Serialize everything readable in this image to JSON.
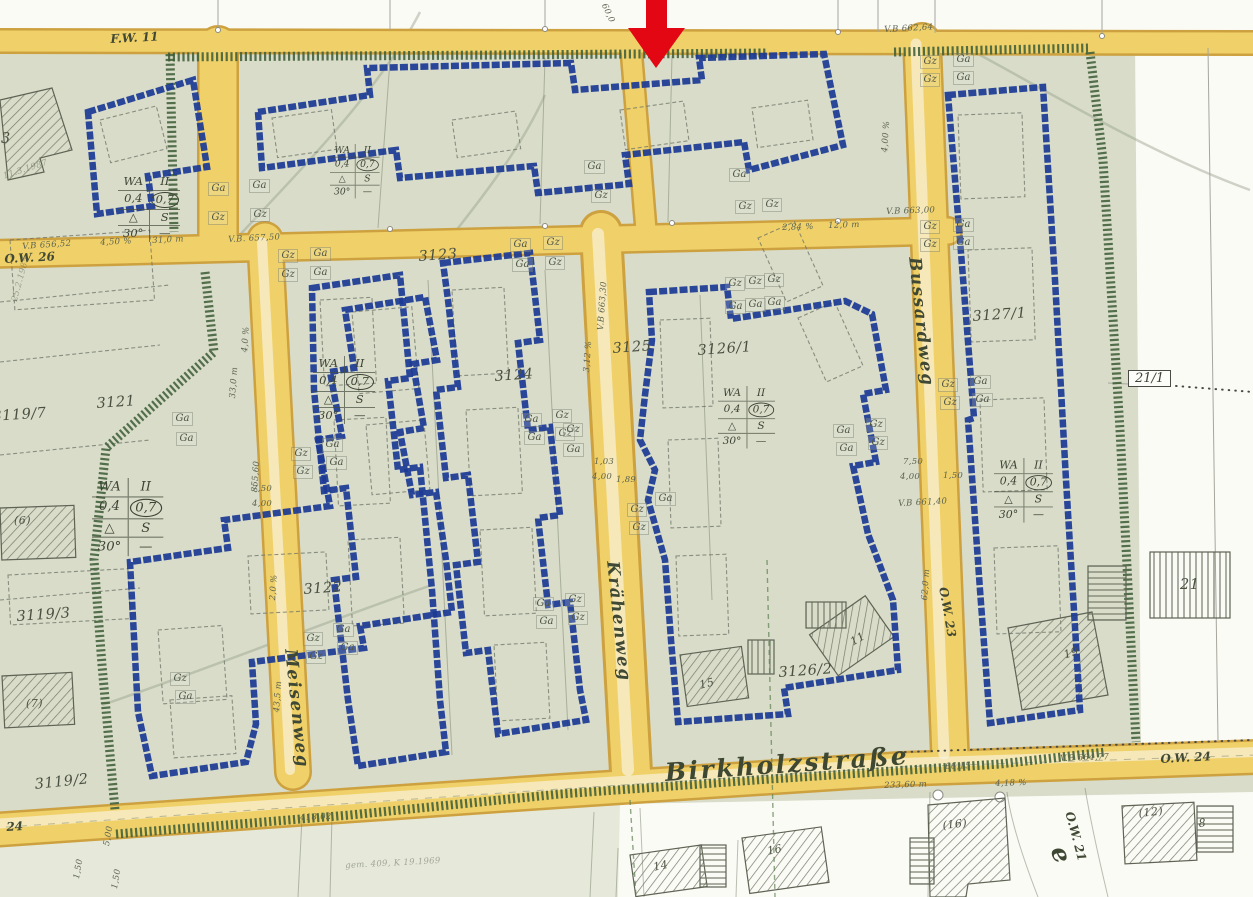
{
  "map": {
    "title": "Bebauungsplan Ausschnitt Birkholzstraße",
    "colors": {
      "envelope_blue": "#1c3a94",
      "road_fill": "#f0d169",
      "road_edge": "#cda13f",
      "boundary_green": "#3f5e38",
      "arrow_red": "#e30613",
      "plan_wash": "#d8dcc9"
    },
    "marker": {
      "name": "red-arrow",
      "color": "#e30613"
    },
    "street_labels": [
      {
        "t": "F.W. 11",
        "x": 110,
        "y": 32,
        "r": -3,
        "s": "sm"
      },
      {
        "t": "O.W. 26",
        "x": 4,
        "y": 252,
        "r": -3,
        "s": "sm"
      },
      {
        "t": "Meisenweg",
        "x": 300,
        "y": 648,
        "r": 84,
        "s": "lg"
      },
      {
        "t": "Krähenweg",
        "x": 622,
        "y": 560,
        "r": 84,
        "s": "lg"
      },
      {
        "t": "Bussardweg",
        "x": 924,
        "y": 256,
        "r": 84,
        "s": "lg"
      },
      {
        "t": "Birkholzstraße",
        "x": 664,
        "y": 758,
        "r": -4,
        "s": "xl"
      },
      {
        "t": "O.W. 23",
        "x": 950,
        "y": 586,
        "r": 80,
        "s": "sm"
      },
      {
        "t": "O.W. 24",
        "x": 1160,
        "y": 752,
        "r": -3,
        "s": "sm"
      },
      {
        "t": "O.W. 21",
        "x": 1076,
        "y": 810,
        "r": 75,
        "s": "sm"
      },
      {
        "t": "24",
        "x": 6,
        "y": 820,
        "r": -3,
        "s": "sm"
      },
      {
        "t": "e",
        "x": 1072,
        "y": 842,
        "r": 70,
        "s": "xl"
      }
    ],
    "parcel_labels": [
      {
        "t": "3121",
        "x": 96,
        "y": 396,
        "r": -4
      },
      {
        "t": "3122",
        "x": 303,
        "y": 582,
        "r": -4
      },
      {
        "t": "3123",
        "x": 418,
        "y": 249,
        "r": -4
      },
      {
        "t": "3124",
        "x": 494,
        "y": 369,
        "r": -4
      },
      {
        "t": "3125",
        "x": 612,
        "y": 341,
        "r": -4
      },
      {
        "t": "3126/1",
        "x": 697,
        "y": 343,
        "r": -4
      },
      {
        "t": "3126/2",
        "x": 778,
        "y": 665,
        "r": -4
      },
      {
        "t": "3127/1",
        "x": 972,
        "y": 309,
        "r": -4
      },
      {
        "t": "3119/7",
        "x": -8,
        "y": 409,
        "r": -4
      },
      {
        "t": "3119/3",
        "x": 16,
        "y": 609,
        "r": -4
      },
      {
        "t": "3119/2",
        "x": 34,
        "y": 777,
        "r": -6
      },
      {
        "t": "21",
        "x": 1180,
        "y": 577,
        "r": 0
      },
      {
        "t": "19",
        "x": 1062,
        "y": 649,
        "r": -18,
        "sm": true
      },
      {
        "t": "3",
        "x": 1,
        "y": 131,
        "r": 0
      },
      {
        "t": "(6)",
        "x": 14,
        "y": 514,
        "r": 0,
        "sm": true
      },
      {
        "t": "(7)",
        "x": 26,
        "y": 697,
        "r": 0,
        "sm": true
      },
      {
        "t": "(16)",
        "x": 942,
        "y": 819,
        "r": -6,
        "sm": true
      },
      {
        "t": "(12)",
        "x": 1138,
        "y": 807,
        "r": -6,
        "sm": true
      },
      {
        "t": "14",
        "x": 652,
        "y": 861,
        "r": -12,
        "sm": true
      },
      {
        "t": "16",
        "x": 766,
        "y": 845,
        "r": -12,
        "sm": true
      },
      {
        "t": "15",
        "x": 698,
        "y": 679,
        "r": -14,
        "sm": true
      },
      {
        "t": "11",
        "x": 848,
        "y": 637,
        "r": -30,
        "sm": true
      },
      {
        "t": "8",
        "x": 1198,
        "y": 817,
        "r": -6,
        "sm": true
      }
    ],
    "parcel_box": {
      "t": "21/1",
      "x": 1128,
      "y": 370
    },
    "garage_labels": [
      {
        "t": "Ga",
        "x": 208,
        "y": 182
      },
      {
        "t": "Gz",
        "x": 208,
        "y": 211
      },
      {
        "t": "Ga",
        "x": 249,
        "y": 179
      },
      {
        "t": "Gz",
        "x": 250,
        "y": 208
      },
      {
        "t": "Ga",
        "x": 584,
        "y": 160
      },
      {
        "t": "Gz",
        "x": 591,
        "y": 189
      },
      {
        "t": "Ga",
        "x": 729,
        "y": 168
      },
      {
        "t": "Gz",
        "x": 735,
        "y": 200
      },
      {
        "t": "Gz",
        "x": 762,
        "y": 198
      },
      {
        "t": "Gz",
        "x": 920,
        "y": 55
      },
      {
        "t": "Ga",
        "x": 953,
        "y": 53
      },
      {
        "t": "Gz",
        "x": 920,
        "y": 73
      },
      {
        "t": "Ga",
        "x": 953,
        "y": 71
      },
      {
        "t": "Gz",
        "x": 920,
        "y": 220
      },
      {
        "t": "Ga",
        "x": 953,
        "y": 218
      },
      {
        "t": "Gz",
        "x": 920,
        "y": 238
      },
      {
        "t": "Ga",
        "x": 953,
        "y": 236
      },
      {
        "t": "Gz",
        "x": 278,
        "y": 249
      },
      {
        "t": "Ga",
        "x": 310,
        "y": 247
      },
      {
        "t": "Gz",
        "x": 278,
        "y": 268
      },
      {
        "t": "Ga",
        "x": 310,
        "y": 266
      },
      {
        "t": "Ga",
        "x": 510,
        "y": 238
      },
      {
        "t": "Gz",
        "x": 543,
        "y": 236
      },
      {
        "t": "Ga",
        "x": 512,
        "y": 258
      },
      {
        "t": "Gz",
        "x": 545,
        "y": 256
      },
      {
        "t": "Ga",
        "x": 172,
        "y": 412
      },
      {
        "t": "Ga",
        "x": 176,
        "y": 432
      },
      {
        "t": "Ga",
        "x": 322,
        "y": 438
      },
      {
        "t": "Gz",
        "x": 291,
        "y": 447
      },
      {
        "t": "Ga",
        "x": 326,
        "y": 456
      },
      {
        "t": "Gz",
        "x": 293,
        "y": 465
      },
      {
        "t": "Ga",
        "x": 521,
        "y": 413
      },
      {
        "t": "Gz",
        "x": 552,
        "y": 409
      },
      {
        "t": "Ga",
        "x": 524,
        "y": 431
      },
      {
        "t": "Gz",
        "x": 555,
        "y": 427
      },
      {
        "t": "Gz",
        "x": 725,
        "y": 277
      },
      {
        "t": "Gz",
        "x": 745,
        "y": 275
      },
      {
        "t": "Gz",
        "x": 764,
        "y": 273
      },
      {
        "t": "Ga",
        "x": 725,
        "y": 300
      },
      {
        "t": "Ga",
        "x": 745,
        "y": 298
      },
      {
        "t": "Ga",
        "x": 764,
        "y": 296
      },
      {
        "t": "Ga",
        "x": 833,
        "y": 424
      },
      {
        "t": "Gz",
        "x": 866,
        "y": 418
      },
      {
        "t": "Ga",
        "x": 836,
        "y": 442
      },
      {
        "t": "Gz",
        "x": 868,
        "y": 436
      },
      {
        "t": "Gz",
        "x": 938,
        "y": 378
      },
      {
        "t": "Ga",
        "x": 970,
        "y": 375
      },
      {
        "t": "Gz",
        "x": 940,
        "y": 396
      },
      {
        "t": "Ga",
        "x": 972,
        "y": 393
      },
      {
        "t": "Gz",
        "x": 563,
        "y": 423
      },
      {
        "t": "Ga",
        "x": 563,
        "y": 443
      },
      {
        "t": "Ga",
        "x": 655,
        "y": 492
      },
      {
        "t": "Gz",
        "x": 627,
        "y": 503
      },
      {
        "t": "Gz",
        "x": 629,
        "y": 521
      },
      {
        "t": "Ga",
        "x": 333,
        "y": 623
      },
      {
        "t": "Gz",
        "x": 303,
        "y": 632
      },
      {
        "t": "Ga",
        "x": 337,
        "y": 641
      },
      {
        "t": "Gz",
        "x": 306,
        "y": 650
      },
      {
        "t": "Ga",
        "x": 533,
        "y": 597
      },
      {
        "t": "Gz",
        "x": 565,
        "y": 593
      },
      {
        "t": "Ga",
        "x": 536,
        "y": 615
      },
      {
        "t": "Gz",
        "x": 568,
        "y": 611
      },
      {
        "t": "Gz",
        "x": 170,
        "y": 672
      },
      {
        "t": "Ga",
        "x": 175,
        "y": 690
      }
    ],
    "dimension_labels": [
      {
        "t": "60,0",
        "x": 608,
        "y": 2,
        "r": 65
      },
      {
        "t": "V.B 662,64",
        "x": 884,
        "y": 25,
        "r": -3
      },
      {
        "t": "4,00 %",
        "x": 880,
        "y": 152,
        "r": -86
      },
      {
        "t": "V.B 656,52",
        "x": 22,
        "y": 242,
        "r": -4
      },
      {
        "t": "4,50 %",
        "x": 100,
        "y": 238,
        "r": -3
      },
      {
        "t": "31,0 m",
        "x": 152,
        "y": 236,
        "r": -3
      },
      {
        "t": "V.B. 657,50",
        "x": 228,
        "y": 235,
        "r": -3
      },
      {
        "t": "2,84 %",
        "x": 782,
        "y": 223,
        "r": -2
      },
      {
        "t": "12,0 m",
        "x": 828,
        "y": 221,
        "r": -2
      },
      {
        "t": "V.B 663,00",
        "x": 886,
        "y": 207,
        "r": -2
      },
      {
        "t": "4,0 %",
        "x": 240,
        "y": 352,
        "r": -86
      },
      {
        "t": "33,0 m",
        "x": 228,
        "y": 398,
        "r": -86
      },
      {
        "t": "855,60",
        "x": 250,
        "y": 492,
        "r": -86
      },
      {
        "t": "7,50",
        "x": 252,
        "y": 484,
        "r": 0
      },
      {
        "t": "4,00",
        "x": 252,
        "y": 499,
        "r": 0
      },
      {
        "t": "2,0 %",
        "x": 268,
        "y": 600,
        "r": -86
      },
      {
        "t": "43,5 m",
        "x": 272,
        "y": 712,
        "r": -86
      },
      {
        "t": "3,12 %",
        "x": 582,
        "y": 372,
        "r": -86
      },
      {
        "t": "V.B 663,30",
        "x": 596,
        "y": 330,
        "r": -86
      },
      {
        "t": "1,03",
        "x": 594,
        "y": 457,
        "r": 0
      },
      {
        "t": "4,00",
        "x": 592,
        "y": 472,
        "r": 0
      },
      {
        "t": "1,89",
        "x": 616,
        "y": 475,
        "r": 0
      },
      {
        "t": "7,50",
        "x": 903,
        "y": 457,
        "r": 0
      },
      {
        "t": "4,00",
        "x": 900,
        "y": 472,
        "r": 0
      },
      {
        "t": "1,50",
        "x": 943,
        "y": 471,
        "r": 0
      },
      {
        "t": "V.B 661,40",
        "x": 898,
        "y": 499,
        "r": -3
      },
      {
        "t": "62,0 m",
        "x": 920,
        "y": 600,
        "r": -86
      },
      {
        "t": "4,18 %",
        "x": 995,
        "y": 779,
        "r": -2
      },
      {
        "t": "66,15",
        "x": 945,
        "y": 762,
        "r": -2
      },
      {
        "t": "V.B 664,77",
        "x": 1060,
        "y": 754,
        "r": -2
      },
      {
        "t": "233,60 m",
        "x": 884,
        "y": 781,
        "r": -2
      },
      {
        "t": "418,02",
        "x": 300,
        "y": 813,
        "r": -2
      },
      {
        "t": "5,00",
        "x": 102,
        "y": 845,
        "r": -80
      },
      {
        "t": "1,50",
        "x": 72,
        "y": 878,
        "r": -80
      },
      {
        "t": "1,50",
        "x": 110,
        "y": 888,
        "r": -80
      },
      {
        "t": "gem. 409, K 19.1969",
        "x": 345,
        "y": 861,
        "r": -3,
        "f": true
      },
      {
        "t": "25.2.1985",
        "x": 10,
        "y": 300,
        "r": -75,
        "f": true
      },
      {
        "t": "11.3.1987",
        "x": 2,
        "y": 172,
        "r": -18,
        "f": true
      }
    ],
    "zoning": {
      "rows": [
        {
          "l": "WA",
          "r": "II"
        },
        {
          "l": "0,4",
          "r": "0,7",
          "oval": true
        },
        {
          "l": "△",
          "r": "S",
          "tri": true
        },
        {
          "l": "30°",
          "r": "—"
        }
      ],
      "boxes": [
        {
          "x": 118,
          "y": 174,
          "s": 1
        },
        {
          "x": 330,
          "y": 144,
          "s": 0.8
        },
        {
          "x": 313,
          "y": 356,
          "s": 1
        },
        {
          "x": 92,
          "y": 478,
          "s": 1.15
        },
        {
          "x": 718,
          "y": 386,
          "s": 0.92
        },
        {
          "x": 994,
          "y": 458,
          "s": 0.95
        }
      ]
    }
  }
}
